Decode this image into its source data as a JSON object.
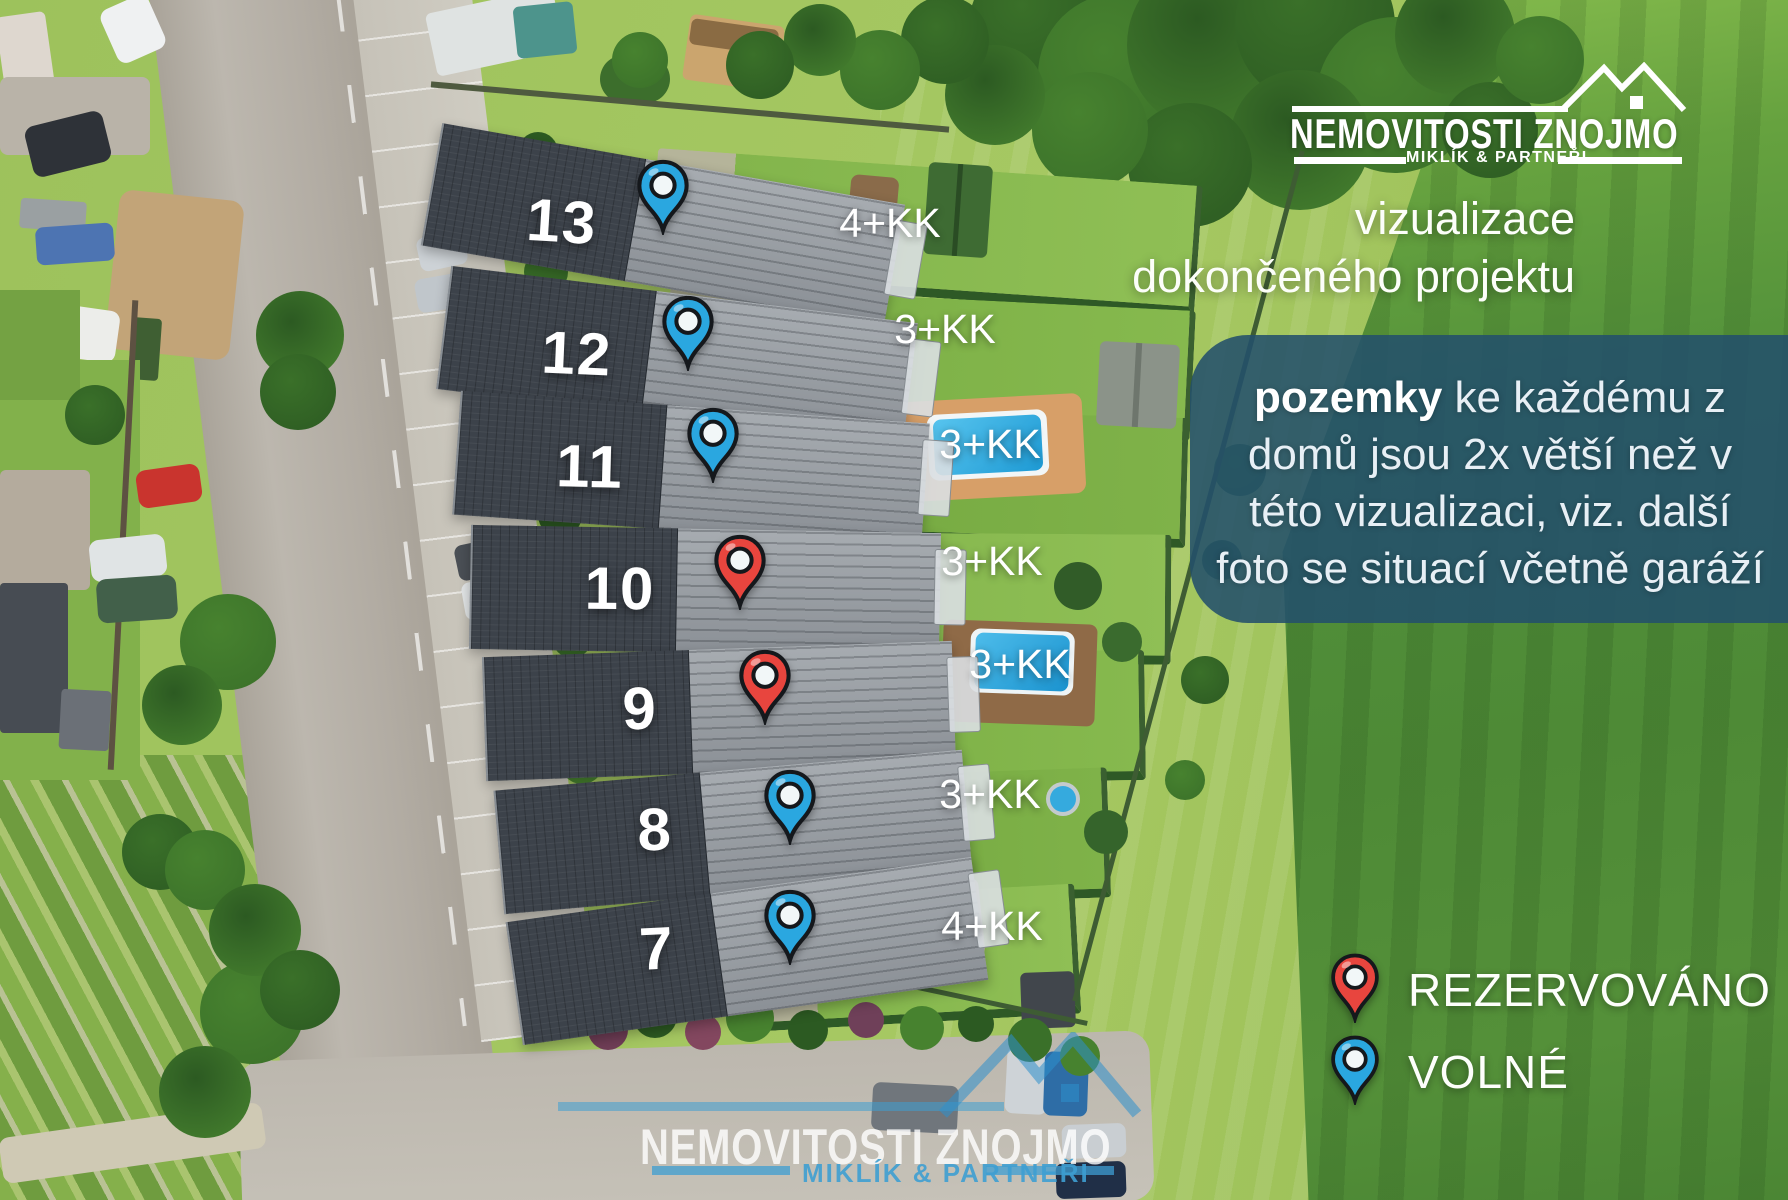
{
  "logo": {
    "brand": "NEMOVITOSTI ZNOJMO",
    "subtitle": "MIKLÍK & PARTNEŘI"
  },
  "tagline": {
    "line1": "vizualizace",
    "line2": "dokončeného projektu"
  },
  "info_box": {
    "lead": "pozemky",
    "line1_rest": " ke každému z",
    "line2": "domů jsou 2x větší než v",
    "line3": "této vizualizaci, viz. další",
    "line4": "foto se situací včetně garáží"
  },
  "houses": [
    {
      "number": "13",
      "status": "volne",
      "layout": "4+KK"
    },
    {
      "number": "12",
      "status": "volne",
      "layout": "3+KK"
    },
    {
      "number": "11",
      "status": "volne",
      "layout": "3+KK"
    },
    {
      "number": "10",
      "status": "rezervovano",
      "layout": "3+KK"
    },
    {
      "number": "9",
      "status": "rezervovano",
      "layout": "3+KK"
    },
    {
      "number": "8",
      "status": "volne",
      "layout": "3+KK"
    },
    {
      "number": "7",
      "status": "volne",
      "layout": "4+KK"
    }
  ],
  "legend": {
    "items": [
      {
        "status": "rezervovano",
        "label": "REZERVOVÁNO"
      },
      {
        "status": "volne",
        "label": "VOLNÉ"
      }
    ]
  },
  "status_colors": {
    "volne": "#2aa7e0",
    "rezervovano": "#e8453e"
  },
  "watermark": {
    "brand": "NEMOVITOSTI ZNOJMO",
    "subtitle": "MIKLÍK & PARTNEŘI"
  }
}
